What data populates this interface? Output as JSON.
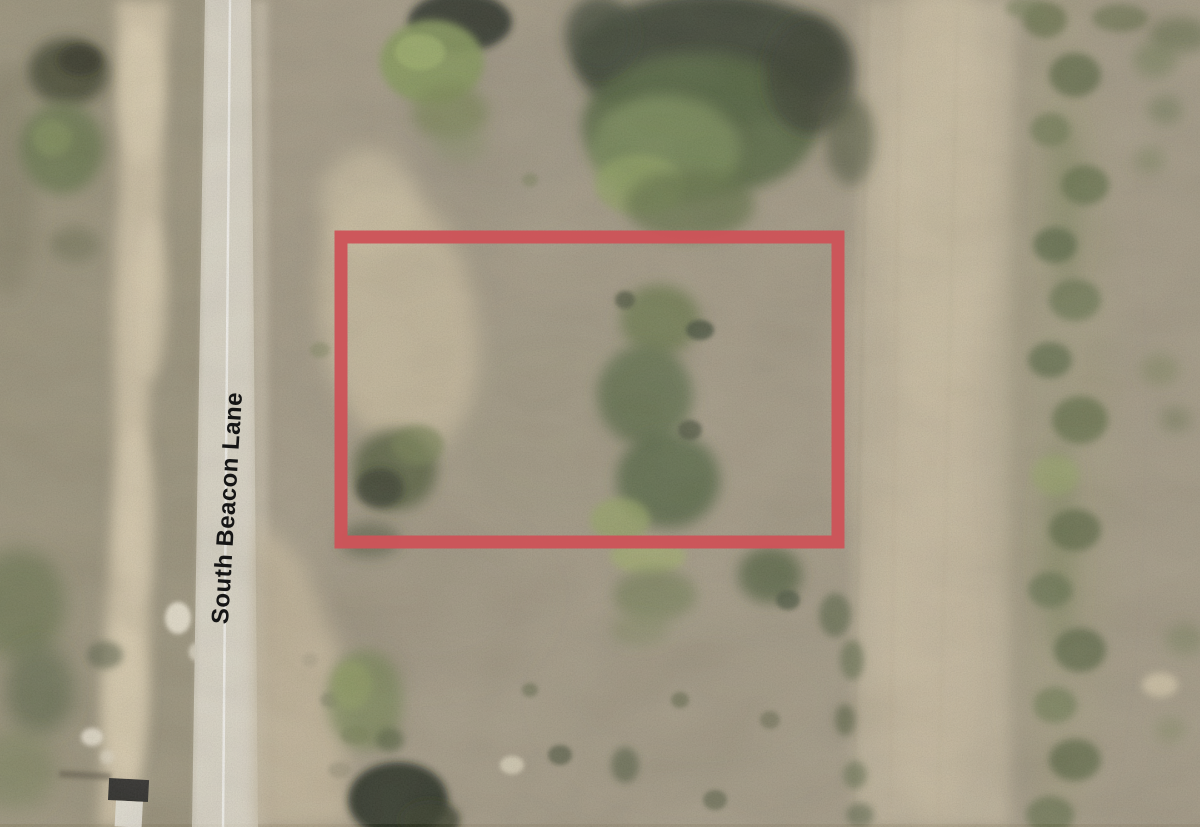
{
  "scene": {
    "kind": "aerial-satellite-photo",
    "subject": "Vacant desert land parcel outlined in red next to a paved road"
  },
  "road": {
    "label": "South Beacon Lane"
  },
  "parcel_overlay": {
    "shape": "rectangle",
    "outline_color": "#cd5358",
    "outline_width_px": 13
  },
  "colors": {
    "field": "#9c9179",
    "left_scrub": "#92896e",
    "sand_wash": "#cfc0a0",
    "road_surface": "#d9d3c2",
    "road_centerline": "#f8f6ef",
    "right_trail": "#b7aa8e",
    "tree_dark": "#232b18",
    "tree_mid": "#47562e",
    "tree_bright": "#7c8f4b",
    "road_label_text": "#151515"
  }
}
